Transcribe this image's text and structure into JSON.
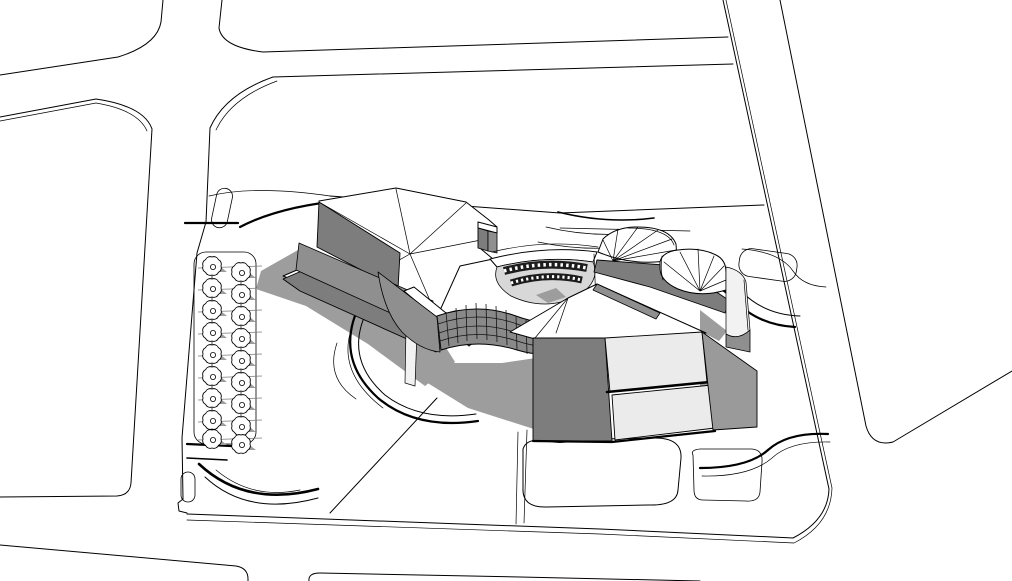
{
  "scene": {
    "type": "3d-architectural-model-render",
    "style": "monochrome hidden-line perspective rendering (SketchUp-like)",
    "description": "Aerial hidden-line rendering of a cultural-center massing model: faceted white roofs around a sunken circular courtyard with two ring window bands, a curved gridded curtain wall, a stepped wedge block to the south-east, fan-shaped annex volumes to the east, a tree-lined parking strip on the west, curved landscape paths, and surrounding roads with a flared intersection at the top left and a diagonal road on the right."
  },
  "palette": {
    "paper": "#ffffff",
    "line": "#000000",
    "dark_wall": "#7d7d7d",
    "mid_wall": "#8f8f8f",
    "light_face": "#ebebeb",
    "lit_face": "#f2f2f2",
    "shadow": "#9d9d9d",
    "glass_wall": "#898989",
    "grid_line": "#141414",
    "courtyard_floor": "#d8d8d8",
    "window_band": "#1c1c1c",
    "window_slit": "#ffffff",
    "tree_shadow": "#9d9d9d"
  },
  "counts": {
    "parking_trees": 18,
    "curtain_wall_mullion_columns": 14,
    "curtain_wall_rows": 4,
    "courtyard_window_bands": 2,
    "fan_roof_volumes": 2
  }
}
